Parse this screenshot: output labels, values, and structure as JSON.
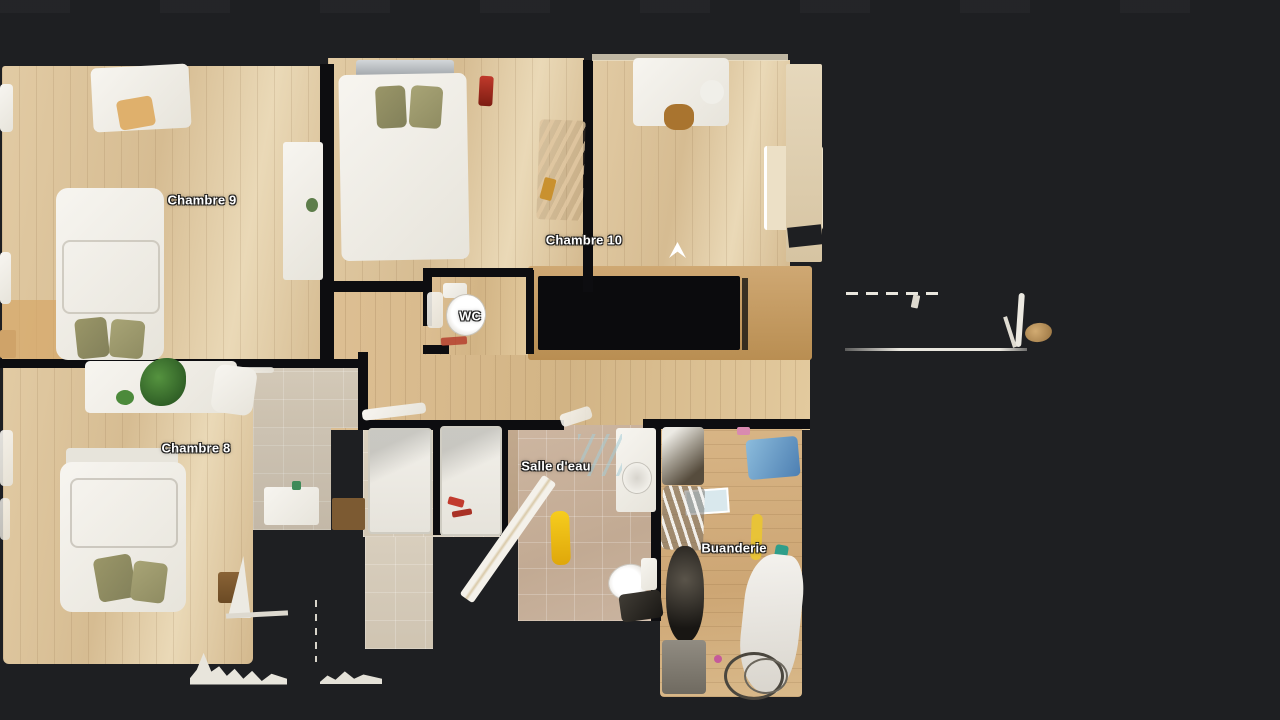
{
  "viewer": {
    "type": "3d-floorplan-dollhouse-view",
    "background": "#1e1f22"
  },
  "rooms": [
    {
      "id": "chambre-9",
      "label": "Chambre 9"
    },
    {
      "id": "chambre-10",
      "label": "Chambre 10"
    },
    {
      "id": "wc",
      "label": "WC"
    },
    {
      "id": "chambre-8",
      "label": "Chambre 8"
    },
    {
      "id": "salle-deau",
      "label": "Salle d'eau"
    },
    {
      "id": "buanderie",
      "label": "Buanderie"
    }
  ],
  "icons": {
    "nav_arrow": "walk-here-arrow"
  },
  "colors": {
    "background": "#1e1f22",
    "wall": "#0d0d10",
    "floor_wood_light": "#dcc49e",
    "floor_wood_warm": "#d8bb8e",
    "floor_wood_orange": "#d1ad7c",
    "tile": "#cfc5b4",
    "tile_pink": "#c9b29d",
    "label_text": "#ffffff",
    "bed_white": "#f4f1ea",
    "pillow_olive": "#8f8a5f",
    "accent_yellow": "#eec81e",
    "accent_blue": "#6d9fc9",
    "accent_red": "#b5402e"
  }
}
